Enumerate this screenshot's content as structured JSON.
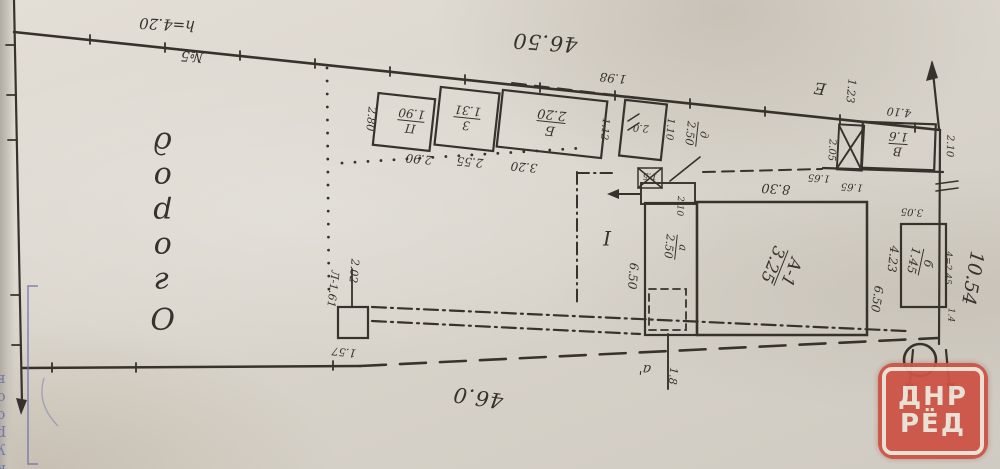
{
  "scan": {
    "paper": "#dcd7ce",
    "ink": "#37322b",
    "red": "#cd5246",
    "blue": "#6870a8"
  },
  "boundary": {
    "top_length": "46.50",
    "top_note": "h=4.20",
    "top_note2": "№5",
    "bottom_length": "46.0",
    "right_width": "10.54",
    "right_note": "4=2.45",
    "right_note2": "1.4",
    "seg_198": "1.98",
    "tie1": "1.65",
    "tie2": "1.65",
    "fence_gap": "3.05"
  },
  "garden": {
    "label": "Огород"
  },
  "courtyard": {
    "label": "I"
  },
  "well_mark": {
    "name": "Л-1.61",
    "h": "2.02",
    "dim": "1.57"
  },
  "sheds": {
    "p": {
      "letter": "П",
      "height": "1.90",
      "width": "2.90",
      "side": "2.80"
    },
    "z": {
      "letter": "З",
      "height": "1.31",
      "width": "2.55"
    },
    "b": {
      "letter": "Б",
      "height": "2.20",
      "width": "3.20",
      "side": "1.12"
    },
    "n": {
      "value": "2.0",
      "side": "1.10"
    }
  },
  "cellar": {
    "letter": "д",
    "value": "2.50",
    "mark": "1.5"
  },
  "house": {
    "letter": "А-1",
    "area": "3.25",
    "top": "8.30",
    "right1": "4.23",
    "right2": "6.50"
  },
  "annex": {
    "letter": "а",
    "value": "2.50",
    "top": "2.10",
    "left": "6.50"
  },
  "porch": {
    "letter": "а'",
    "dim": "1.8"
  },
  "shed_e": {
    "letter": "Е",
    "height": "1.23",
    "side": "2.05"
  },
  "shed_v": {
    "letter": "В",
    "height": "1.6",
    "top": "4.10",
    "side": "2.10"
  },
  "shed_b2": {
    "letter": "б",
    "height": "1.45"
  },
  "watermark": {
    "line1": "ДНР",
    "line2": "РЁД"
  },
  "stamp": {
    "text": "курсов"
  }
}
